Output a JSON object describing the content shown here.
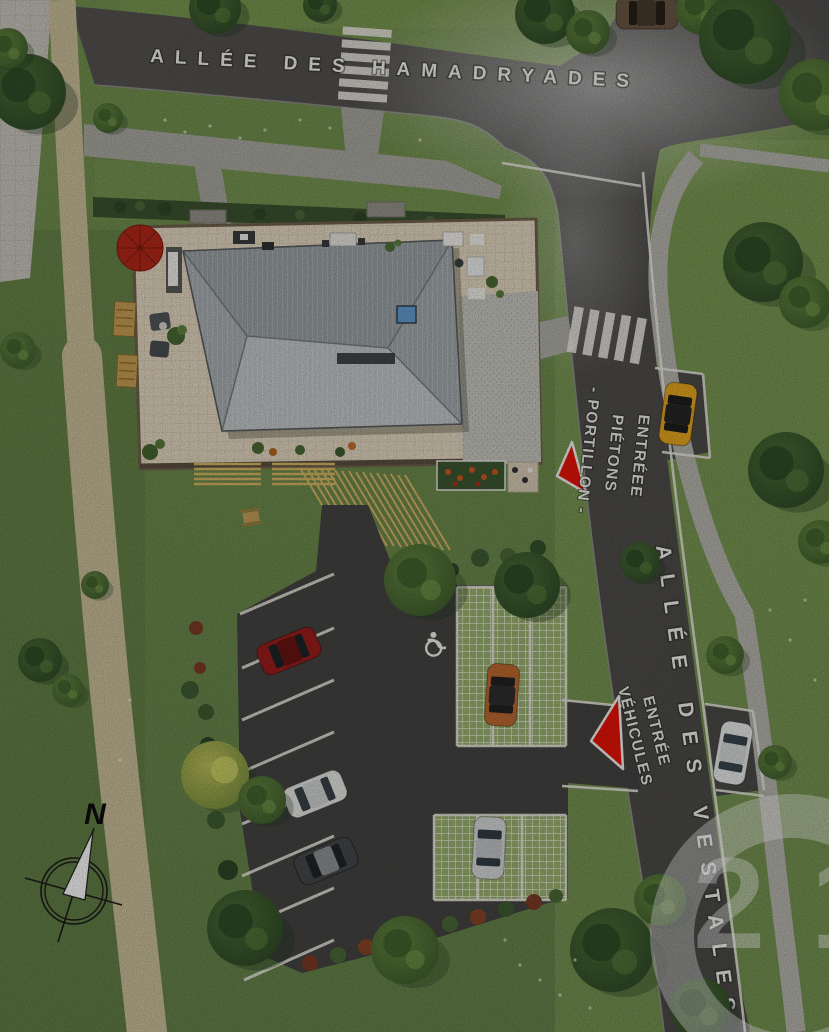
{
  "streets": {
    "top_name": "ALLÉE DES HAMADRYADES",
    "right_name": "ALLÉE DES VESTALES"
  },
  "entrances": {
    "pedestrian": {
      "line1": "ENTRÉEE",
      "line2": "PIÉTONS",
      "line3": "- PORTILLON -"
    },
    "vehicle": {
      "line1": "ENTRÉE",
      "line2": "VÉHICULES"
    }
  },
  "compass": {
    "north_label": "N"
  },
  "watermark": {
    "logo_text": "21"
  },
  "colors": {
    "entrance_arrow_red": "#e81408",
    "parasol_red": "#b5281a",
    "roof_gray": "#9aa1a5",
    "grass_green": "#6d8a4c",
    "asphalt_gray": "#4e4d4b",
    "path_tan": "#cbbf9a",
    "marking_white": "#eceae2"
  }
}
